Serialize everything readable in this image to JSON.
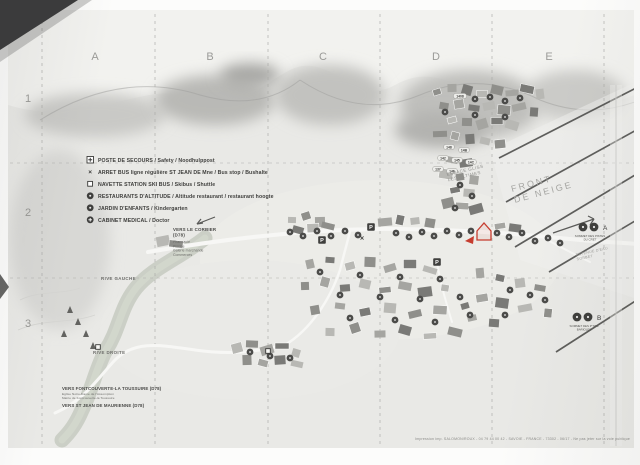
{
  "grid": {
    "columns": [
      "A",
      "B",
      "C",
      "D",
      "E"
    ],
    "rows": [
      "1",
      "2",
      "3"
    ],
    "column_xs": [
      95,
      210,
      323,
      436,
      549
    ],
    "column_y": 60,
    "row_x": 28,
    "row_ys": [
      102,
      216,
      327
    ]
  },
  "legend": {
    "x": 90,
    "y": 162,
    "row_h": 12,
    "items": [
      {
        "icon": "first-aid-icon",
        "label": "POSTE DE SECOURS / Safety / Noodhulppost"
      },
      {
        "icon": "bus-stop-icon",
        "label": "ARRET BUS ligne régulière ST JEAN DE Mne / Bus stop / Bushalte"
      },
      {
        "icon": "shuttle-stop-icon",
        "label": "NAVETTE STATION SKI BUS / Skibus / Shuttle"
      },
      {
        "icon": "restaurant-icon",
        "label": "RESTAURANTS D'ALTITUDE / Altitude restaurant / restaurant hoogte"
      },
      {
        "icon": "kindergarten-icon",
        "label": "JARDIN D'ENFANTS / Kindergarten"
      },
      {
        "icon": "medical-icon",
        "label": "CABINET MEDICAL / Doctor"
      }
    ]
  },
  "labels": [
    {
      "name": "front-de-neige",
      "lines": [
        "FRONT",
        "DE NEIGE"
      ],
      "x": 512,
      "y": 192,
      "size": 9,
      "rot": -15,
      "ls": 2.2,
      "color": "#a5a5a2",
      "weight": 400,
      "anchor": "start"
    },
    {
      "name": "espace-gliss",
      "lines": [
        "ESPACE GLISS",
        "LES ULTIMES"
      ],
      "x": 447,
      "y": 176,
      "size": 4.4,
      "rot": -13,
      "ls": 0.5,
      "color": "#8f8f8c",
      "weight": 400,
      "anchor": "start"
    },
    {
      "name": "retenue-eau",
      "lines": [
        "RETENUE D'EAU",
        "SORBET"
      ],
      "x": 576,
      "y": 256,
      "size": 3.6,
      "rot": -12,
      "ls": 0.3,
      "color": "#9c9c99",
      "weight": 400,
      "anchor": "start"
    },
    {
      "name": "rive-gauche",
      "lines": [
        "RIVE GAUCHE"
      ],
      "x": 101,
      "y": 280,
      "size": 4.4,
      "rot": 0,
      "ls": 0.4,
      "color": "#6e6e6b",
      "weight": 700,
      "anchor": "start"
    },
    {
      "name": "rive-droite",
      "lines": [
        "RIVE DROITE"
      ],
      "x": 93,
      "y": 354,
      "size": 4.4,
      "rot": 0,
      "ls": 0.4,
      "color": "#6e6e6b",
      "weight": 700,
      "anchor": "start"
    },
    {
      "name": "vers-le-corbier",
      "lines": [
        "VERS LE CORBIER",
        "(D78)"
      ],
      "x": 173,
      "y": 231,
      "size": 4.4,
      "rot": 0,
      "ls": 0.2,
      "color": "#4a4a48",
      "weight": 700,
      "anchor": "start"
    },
    {
      "name": "corbier-services",
      "lines": [
        "Pharmacie",
        "Piscine",
        "Galerie marchande",
        "Commerces"
      ],
      "x": 173,
      "y": 243,
      "size": 3.4,
      "rot": 0,
      "ls": 0.1,
      "color": "#6b6b68",
      "weight": 400,
      "anchor": "start"
    },
    {
      "name": "vers-fontcouverte",
      "lines": [
        "VERS FONTCOUVERTE-LA TOUSSUIRE (D78)"
      ],
      "x": 62,
      "y": 390,
      "size": 4.4,
      "rot": 0,
      "ls": 0.1,
      "color": "#4a4a48",
      "weight": 700,
      "anchor": "start"
    },
    {
      "name": "fontcouverte-services",
      "lines": [
        "Eglise Notre-Dame de l'Assomption",
        "Mairie de Fontcouverte-la Toussuire"
      ],
      "x": 62,
      "y": 395,
      "size": 3.1,
      "rot": 0,
      "ls": 0.1,
      "color": "#6b6b68",
      "weight": 400,
      "anchor": "start"
    },
    {
      "name": "vers-st-jean",
      "lines": [
        "VERS ST JEAN DE MAURIENNE (D78)"
      ],
      "x": 62,
      "y": 407,
      "size": 4.4,
      "rot": 0,
      "ls": 0.1,
      "color": "#4a4a48",
      "weight": 700,
      "anchor": "start"
    },
    {
      "name": "marker-a-caption",
      "lines": [
        "SOMMET DES PISTES",
        "DU CRET"
      ],
      "x": 590,
      "y": 237,
      "size": 2.9,
      "rot": 0,
      "ls": 0,
      "color": "#555552",
      "weight": 400,
      "anchor": "middle"
    },
    {
      "name": "marker-b-caption",
      "lines": [
        "SOMMET DES P'TITS",
        "BARIOLES"
      ],
      "x": 584,
      "y": 327,
      "size": 2.9,
      "rot": 0,
      "ls": 0,
      "color": "#555552",
      "weight": 400,
      "anchor": "middle"
    }
  ],
  "markers": {
    "a": {
      "letter": "A",
      "circles": [
        [
          583,
          227
        ],
        [
          594,
          227
        ]
      ],
      "letter_x": 603,
      "letter_y": 230
    },
    "b": {
      "letter": "B",
      "circles": [
        [
          577,
          317
        ],
        [
          588,
          317
        ]
      ],
      "letter_x": 597,
      "letter_y": 320
    },
    "you_are_here": {
      "path": "M477,231 l7,-8 l7,8 v9 h-14 z",
      "arrow": "465,241 474,236 473,244"
    }
  },
  "footer": {
    "text": "Impression imp. SALOMON/ROUX - 04 79 44 00 42 - SAVOIE - FRANCE - 73302 - 06/17 - Ne pas jeter sur la voie publique",
    "x": 630,
    "y": 440
  },
  "map": {
    "buildings": [
      [
        437,
        92
      ],
      [
        452,
        88
      ],
      [
        467,
        90
      ],
      [
        482,
        94
      ],
      [
        497,
        90
      ],
      [
        512,
        93
      ],
      [
        527,
        89
      ],
      [
        540,
        94
      ],
      [
        444,
        106
      ],
      [
        459,
        104
      ],
      [
        474,
        108
      ],
      [
        489,
        106
      ],
      [
        504,
        110
      ],
      [
        519,
        107
      ],
      [
        534,
        112
      ],
      [
        452,
        120
      ],
      [
        467,
        122
      ],
      [
        482,
        124
      ],
      [
        497,
        121
      ],
      [
        512,
        125
      ],
      [
        440,
        134
      ],
      [
        455,
        136
      ],
      [
        470,
        139
      ],
      [
        485,
        141
      ],
      [
        500,
        144
      ],
      [
        452,
        160
      ],
      [
        466,
        163
      ],
      [
        446,
        174
      ],
      [
        460,
        177
      ],
      [
        474,
        180
      ],
      [
        455,
        190
      ],
      [
        469,
        193
      ],
      [
        448,
        203
      ],
      [
        462,
        206
      ],
      [
        476,
        209
      ],
      [
        292,
        220
      ],
      [
        306,
        216
      ],
      [
        320,
        222
      ],
      [
        298,
        230
      ],
      [
        313,
        228
      ],
      [
        328,
        226
      ],
      [
        385,
        222
      ],
      [
        400,
        220
      ],
      [
        415,
        221
      ],
      [
        430,
        223
      ],
      [
        500,
        226
      ],
      [
        515,
        228
      ],
      [
        163,
        241
      ],
      [
        176,
        244
      ],
      [
        310,
        264
      ],
      [
        330,
        260
      ],
      [
        350,
        266
      ],
      [
        370,
        262
      ],
      [
        390,
        268
      ],
      [
        410,
        264
      ],
      [
        430,
        270
      ],
      [
        305,
        286
      ],
      [
        325,
        282
      ],
      [
        345,
        288
      ],
      [
        365,
        284
      ],
      [
        385,
        290
      ],
      [
        405,
        286
      ],
      [
        425,
        292
      ],
      [
        445,
        288
      ],
      [
        315,
        310
      ],
      [
        340,
        306
      ],
      [
        365,
        312
      ],
      [
        390,
        308
      ],
      [
        415,
        314
      ],
      [
        440,
        310
      ],
      [
        465,
        306
      ],
      [
        330,
        332
      ],
      [
        355,
        328
      ],
      [
        380,
        334
      ],
      [
        405,
        330
      ],
      [
        430,
        336
      ],
      [
        455,
        332
      ],
      [
        480,
        273
      ],
      [
        500,
        278
      ],
      [
        520,
        283
      ],
      [
        540,
        288
      ],
      [
        482,
        298
      ],
      [
        502,
        303
      ],
      [
        525,
        308
      ],
      [
        548,
        313
      ],
      [
        472,
        318
      ],
      [
        494,
        323
      ],
      [
        237,
        348
      ],
      [
        252,
        344
      ],
      [
        267,
        350
      ],
      [
        282,
        346
      ],
      [
        296,
        353
      ],
      [
        247,
        360
      ],
      [
        263,
        363
      ],
      [
        280,
        360
      ],
      [
        297,
        364
      ]
    ],
    "badges": [
      [
        290,
        232
      ],
      [
        303,
        236
      ],
      [
        317,
        231
      ],
      [
        331,
        236
      ],
      [
        345,
        231
      ],
      [
        358,
        235
      ],
      [
        396,
        233
      ],
      [
        409,
        237
      ],
      [
        422,
        232
      ],
      [
        434,
        236
      ],
      [
        447,
        231
      ],
      [
        459,
        235
      ],
      [
        471,
        231
      ],
      [
        497,
        233
      ],
      [
        509,
        237
      ],
      [
        522,
        233
      ],
      [
        535,
        241
      ],
      [
        548,
        238
      ],
      [
        560,
        243
      ],
      [
        320,
        272
      ],
      [
        360,
        275
      ],
      [
        400,
        277
      ],
      [
        440,
        279
      ],
      [
        340,
        295
      ],
      [
        380,
        297
      ],
      [
        420,
        299
      ],
      [
        460,
        297
      ],
      [
        350,
        318
      ],
      [
        395,
        320
      ],
      [
        435,
        322
      ],
      [
        470,
        315
      ],
      [
        510,
        290
      ],
      [
        530,
        295
      ],
      [
        505,
        315
      ],
      [
        545,
        300
      ],
      [
        449,
        147,
        "148"
      ],
      [
        464,
        150,
        "14B"
      ],
      [
        443,
        158,
        "142"
      ],
      [
        457,
        160,
        "145"
      ],
      [
        471,
        162,
        "14C"
      ],
      [
        438,
        169,
        "137"
      ],
      [
        452,
        171,
        "146"
      ],
      [
        460,
        96,
        "1408"
      ],
      [
        475,
        99
      ],
      [
        490,
        97
      ],
      [
        505,
        101
      ],
      [
        520,
        98
      ],
      [
        445,
        112
      ],
      [
        475,
        115
      ],
      [
        505,
        117
      ],
      [
        460,
        185
      ],
      [
        472,
        196
      ],
      [
        455,
        208
      ],
      [
        250,
        352
      ],
      [
        270,
        356
      ],
      [
        290,
        358
      ]
    ],
    "parkings": [
      [
        322,
        240
      ],
      [
        371,
        227
      ],
      [
        437,
        262
      ]
    ],
    "bus_stops": [
      [
        362,
        238
      ]
    ],
    "shuttle_stops": [
      [
        98,
        347
      ],
      [
        268,
        351
      ]
    ],
    "trees": [
      [
        70,
        306
      ],
      [
        78,
        318
      ],
      [
        86,
        330
      ],
      [
        93,
        342
      ],
      [
        64,
        330
      ]
    ],
    "slope_lines": [
      [
        499,
        158,
        640,
        86
      ],
      [
        506,
        202,
        640,
        128
      ],
      [
        515,
        247,
        640,
        172
      ],
      [
        549,
        272,
        640,
        218
      ],
      [
        556,
        352,
        640,
        298
      ]
    ],
    "arrows": [
      [
        553,
        233,
        594,
        219
      ],
      [
        594,
        219,
        588,
        216
      ],
      [
        594,
        219,
        590,
        225
      ],
      [
        215,
        217,
        197,
        224
      ],
      [
        197,
        224,
        203,
        223
      ],
      [
        197,
        224,
        201,
        219
      ]
    ],
    "grid_v": [
      42,
      155,
      268,
      380,
      492,
      604
    ],
    "grid_h": [
      163,
      278
    ],
    "crease": [
      616,
      85,
      616,
      446
    ],
    "river": "M205,238 C180,258 152,268 136,288 C120,308 120,328 106,350 C96,368 92,390 82,410 C76,424 70,432 62,440",
    "roads": [
      {
        "d": "M148,252 C230,238 320,228 400,229 C470,230 520,234 580,240 C605,242 625,243 638,244",
        "w": 4
      },
      {
        "d": "M55,413 C85,400 98,378 115,360 C135,340 160,345 195,350 C230,355 255,352 285,345",
        "w": 3
      },
      {
        "d": "M285,345 C310,330 330,300 340,270 C345,250 348,240 350,231",
        "w": 2.5
      },
      {
        "d": "M437,262 C440,282 446,302 452,322",
        "w": 2
      },
      {
        "d": "M540,236 C558,246 574,254 590,262",
        "w": 2
      }
    ],
    "contours": [
      "M20,300 C40,290 60,295 80,288",
      "M18,330 C45,318 70,324 95,315"
    ]
  },
  "colors": {
    "building_shades": [
      "#8f8f8b",
      "#a5a5a1",
      "#7a7a77",
      "#b8b8b4"
    ],
    "badge": "#4b4b49",
    "road": "#f7f7f5",
    "river": "#c6cabf",
    "slope_line": "#4f4f4d",
    "accent_red": "#c63d2f",
    "grid": "#a9a9a6",
    "text_dark": "#3e3e3c"
  }
}
